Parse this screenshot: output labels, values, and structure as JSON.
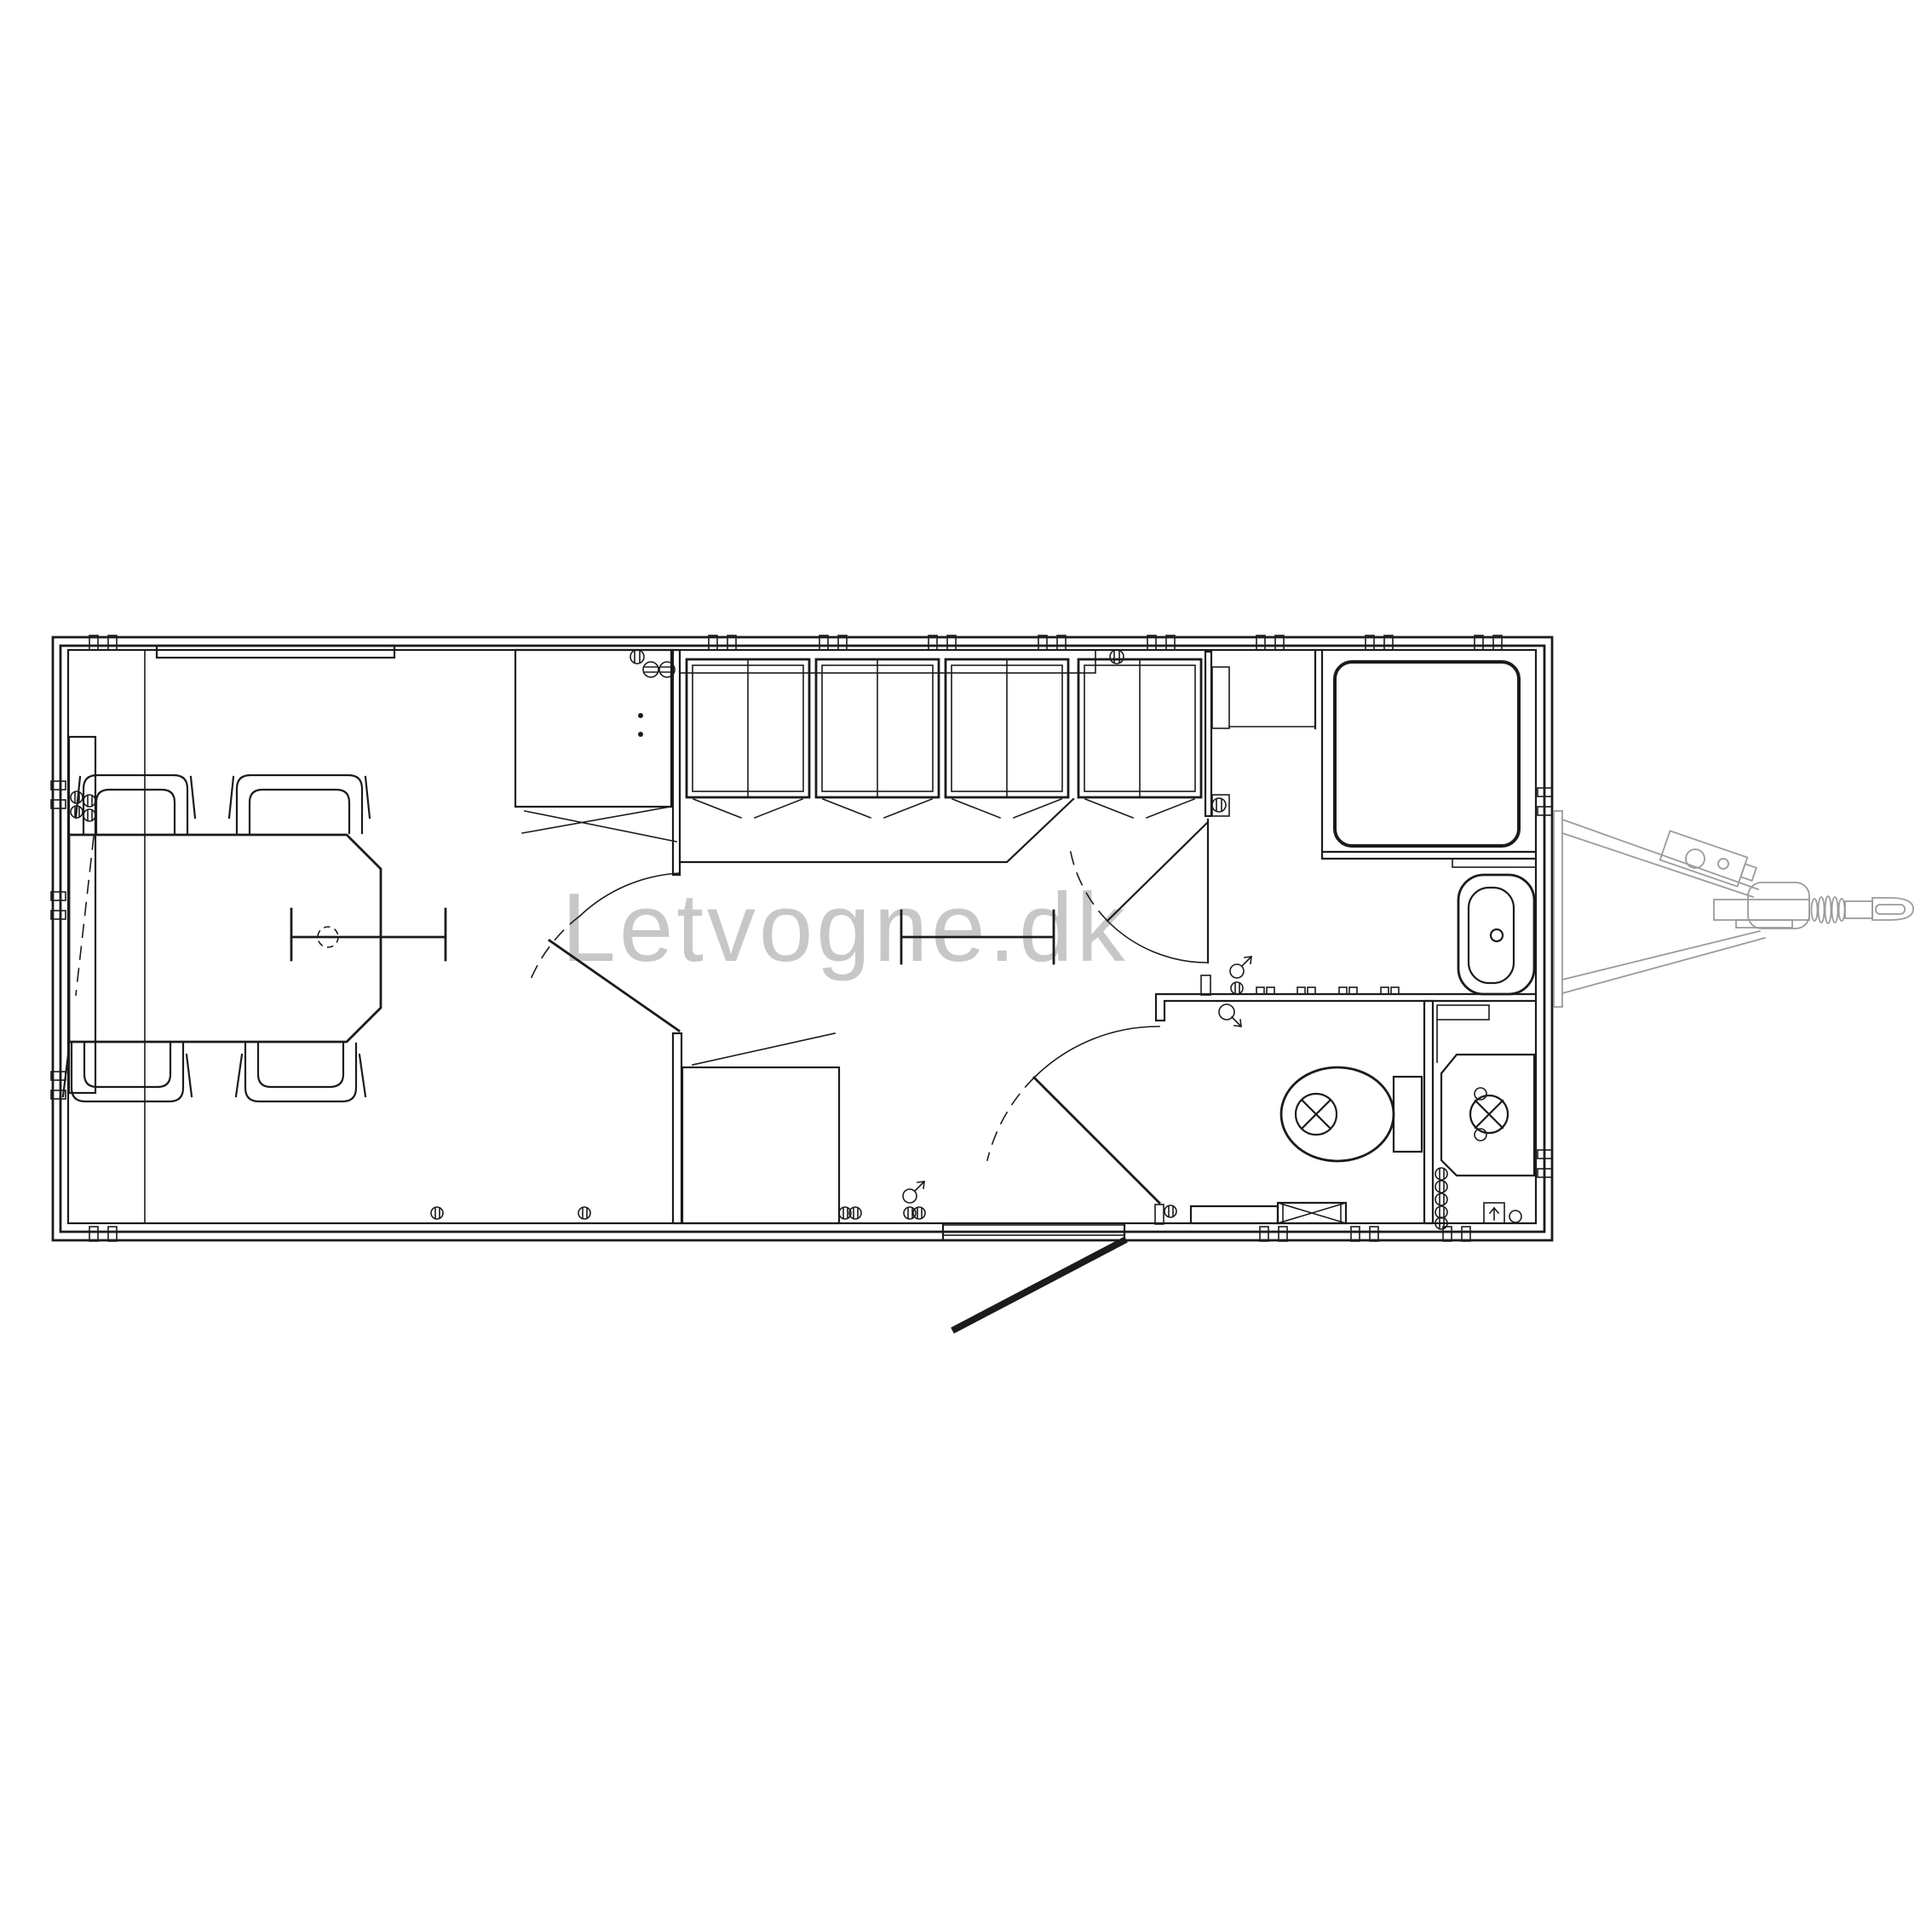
{
  "watermark": {
    "text": "Letvogne.dk"
  },
  "colors": {
    "background": "#ffffff",
    "line": "#1b1b1b",
    "drawbar": "#9b9b9b",
    "watermark": "#c7c7c7"
  },
  "plan": {
    "type": "trailer-floor-plan",
    "rooms": [
      "meeting-room",
      "locker-room",
      "hallway",
      "toilet-room",
      "technical-compartment",
      "shower-room"
    ],
    "fixtures": [
      "window",
      "side-bench",
      "meeting-table",
      "chairs",
      "wardrobe-cabinet",
      "lockers",
      "locker-bench",
      "storage-cabinet",
      "interior-doors",
      "entrance-door",
      "counter-with-hooks",
      "toilet",
      "cistern",
      "step-box",
      "water-heater",
      "floor-drain",
      "shower-tray",
      "wash-basin",
      "drawbar-hitch",
      "jockey-wheel",
      "coupling-head"
    ]
  }
}
